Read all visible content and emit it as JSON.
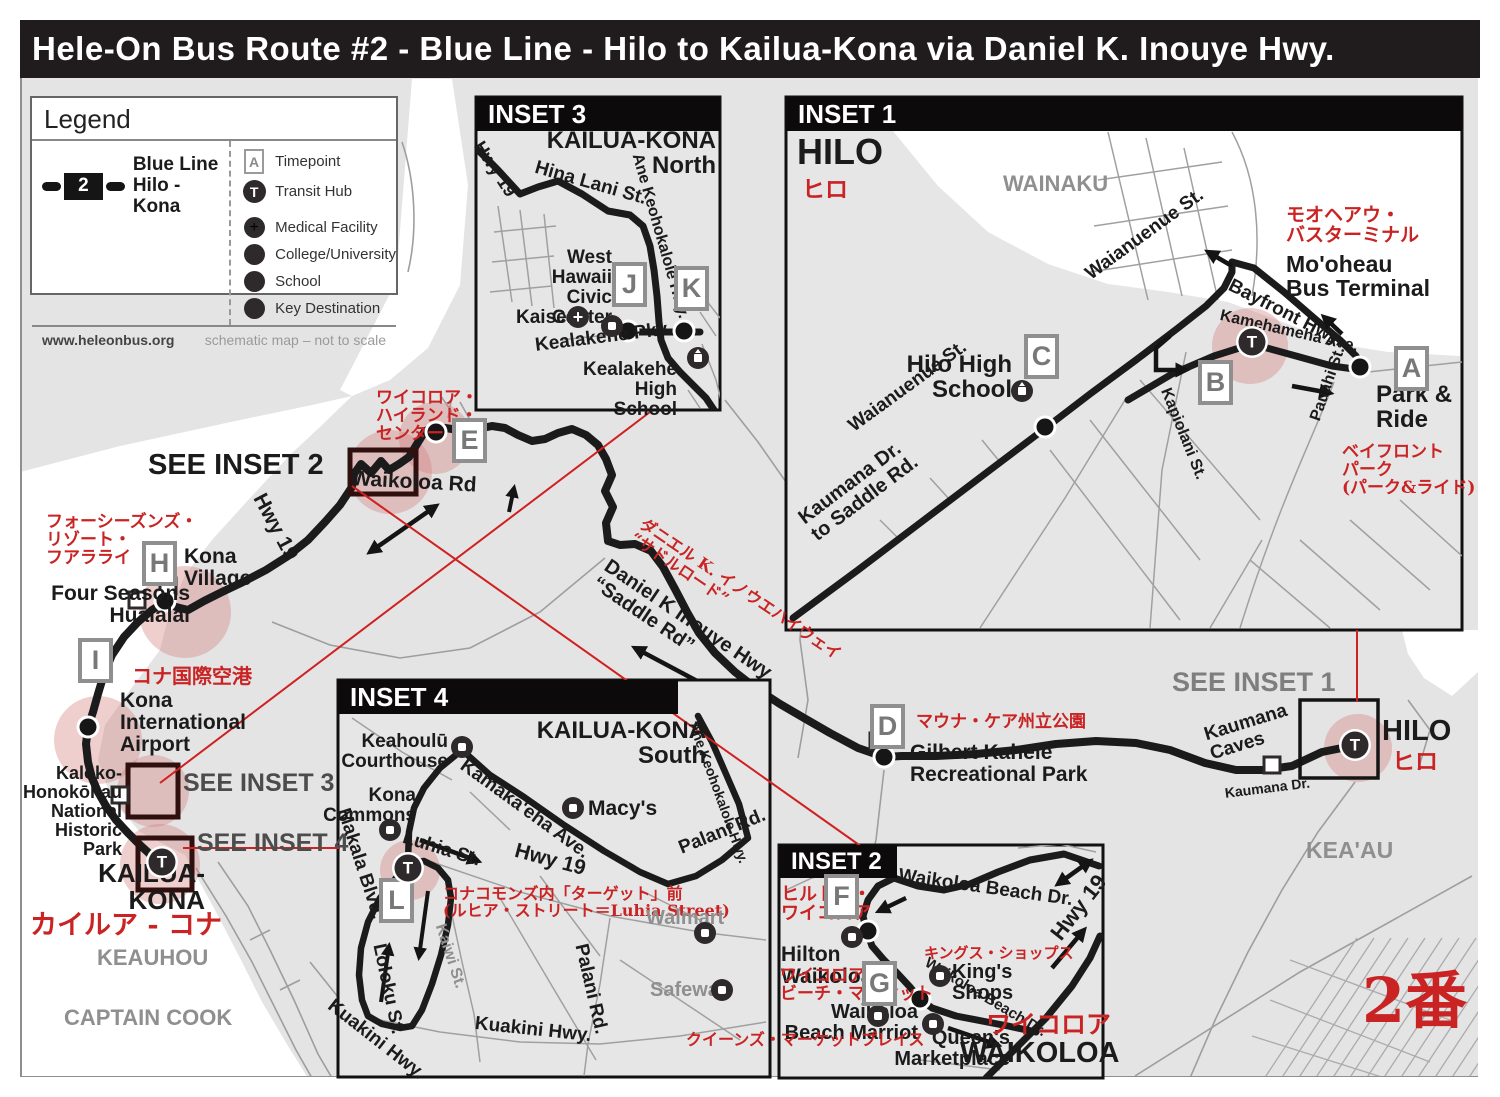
{
  "title": "Hele-On Bus Route #2 - Blue Line - Hilo to Kailua-Kona via Daniel K. Inouye Hwy.",
  "legend": {
    "heading": "Legend",
    "route_badge": "2",
    "route_name": "Blue Line\nHilo - Kona",
    "items": [
      {
        "icon": "timepoint-icon",
        "label": "Timepoint"
      },
      {
        "icon": "transit-hub-icon",
        "label": "Transit Hub"
      },
      {
        "icon": "medical-icon",
        "label": "Medical Facility"
      },
      {
        "icon": "college-icon",
        "label": "College/University"
      },
      {
        "icon": "school-icon",
        "label": "School"
      },
      {
        "icon": "key-destination-icon",
        "label": "Key Destination"
      }
    ],
    "website": "www.heleonbus.org",
    "note": "schematic map – not to scale"
  },
  "transit_hub_letter": "T",
  "insets": {
    "inset1": {
      "header": "INSET 1"
    },
    "inset2": {
      "header": "INSET 2"
    },
    "inset3": {
      "header": "INSET 3"
    },
    "inset4": {
      "header": "INSET 4"
    }
  },
  "map": {
    "labels": [
      {
        "n": "see-inset-2-label",
        "t": "SEE INSET 2",
        "x": 148,
        "y": 450,
        "s": 29,
        "c": "black"
      },
      {
        "n": "waikoloa-rd-label",
        "t": "Waikoloa Rd",
        "x": 352,
        "y": 468,
        "s": 21,
        "c": "black",
        "r": 3
      },
      {
        "n": "hwy-19-label-main",
        "t": "Hwy 19",
        "x": 268,
        "y": 490,
        "s": 21,
        "c": "black",
        "r": 62
      },
      {
        "n": "waikoloa-highlands-jp",
        "t": "ワイコロア・\nハイランド・\nセンター",
        "x": 376,
        "y": 390,
        "s": 17,
        "c": "red"
      },
      {
        "n": "four-seasons-jp",
        "t": "フォーシーズンズ・\nリゾート・\nフアラライ",
        "x": 46,
        "y": 514,
        "s": 17,
        "c": "red"
      },
      {
        "n": "kona-village-label",
        "t": "Kona\nVillage",
        "x": 184,
        "y": 546,
        "s": 21,
        "c": "black"
      },
      {
        "n": "four-seasons-label",
        "t": "Four Seasons\nHualalai",
        "x": 190,
        "y": 583,
        "s": 21,
        "c": "black",
        "a": "r"
      },
      {
        "n": "kona-airport-jp",
        "t": "コナ国際空港",
        "x": 132,
        "y": 666,
        "s": 20,
        "c": "red"
      },
      {
        "n": "kona-airport-label",
        "t": "Kona\nInternational\nAirport",
        "x": 120,
        "y": 690,
        "s": 21,
        "c": "black"
      },
      {
        "n": "kaloko-label",
        "t": "Kaloko-\nHonokōhau\nNational\nHistoric\nPark",
        "x": 122,
        "y": 764,
        "s": 18,
        "c": "black",
        "a": "r"
      },
      {
        "n": "see-inset-3-label",
        "t": "SEE INSET 3",
        "x": 183,
        "y": 770,
        "s": 25,
        "c": "dgray"
      },
      {
        "n": "see-inset-4-label",
        "t": "SEE INSET 4",
        "x": 197,
        "y": 830,
        "s": 25,
        "c": "dgray"
      },
      {
        "n": "kailua-kona-label",
        "t": "KAILUA-\nKONA",
        "x": 205,
        "y": 860,
        "s": 26,
        "c": "black",
        "a": "r"
      },
      {
        "n": "kailua-kona-jp",
        "t": "カイルア - コナ",
        "x": 30,
        "y": 912,
        "s": 27,
        "c": "red"
      },
      {
        "n": "keauhou-label",
        "t": "KEAUHOU",
        "x": 97,
        "y": 946,
        "s": 22,
        "c": "gray"
      },
      {
        "n": "captain-cook-label",
        "t": "CAPTAIN COOK",
        "x": 64,
        "y": 1006,
        "s": 22,
        "c": "gray"
      },
      {
        "n": "daniel-hwy-jp",
        "t": "ダニエル K. イノウエハイウェイ\n“サドルロード”",
        "x": 646,
        "y": 516,
        "s": 16,
        "c": "red",
        "r": 34
      },
      {
        "n": "daniel-hwy-label",
        "t": "Daniel K Inouye Hwy\n“Saddle Rd”",
        "x": 612,
        "y": 556,
        "s": 20,
        "c": "black",
        "r": 34
      },
      {
        "n": "mauna-kea-jp",
        "t": "マウナ・ケア州立公園",
        "x": 916,
        "y": 714,
        "s": 17,
        "c": "red"
      },
      {
        "n": "gilbert-kahele-label",
        "t": "Gilbert Kahele\nRecreational Park",
        "x": 910,
        "y": 742,
        "s": 21,
        "c": "black"
      },
      {
        "n": "see-inset-1-label",
        "t": "SEE INSET 1",
        "x": 1172,
        "y": 668,
        "s": 27,
        "c": "sgray"
      },
      {
        "n": "hilo-label-main",
        "t": "HILO",
        "x": 1382,
        "y": 716,
        "s": 29,
        "c": "black"
      },
      {
        "n": "hilo-jp-main",
        "t": "ヒロ",
        "x": 1392,
        "y": 750,
        "s": 23,
        "c": "red"
      },
      {
        "n": "kaumana-caves-label",
        "t": "Kaumana\nCaves",
        "x": 1202,
        "y": 726,
        "s": 19,
        "c": "black",
        "r": -17
      },
      {
        "n": "kaumana-dr-label",
        "t": "Kaumana Dr.",
        "x": 1224,
        "y": 786,
        "s": 14,
        "c": "black",
        "r": -7
      },
      {
        "n": "keaau-label",
        "t": "KEA'AU",
        "x": 1306,
        "y": 838,
        "s": 23,
        "c": "gray"
      },
      {
        "n": "route-number-jp",
        "t": "2番",
        "x": 1362,
        "y": 968,
        "s": 62,
        "c": "red"
      },
      {
        "n": "inset1-hilo-label",
        "t": "HILO",
        "x": 797,
        "y": 133,
        "s": 36,
        "c": "black"
      },
      {
        "n": "inset1-hilo-jp",
        "t": "ヒロ",
        "x": 802,
        "y": 178,
        "s": 23,
        "c": "red"
      },
      {
        "n": "wainaku-label",
        "t": "WAINAKU",
        "x": 1003,
        "y": 172,
        "s": 22,
        "c": "gray"
      },
      {
        "n": "waianuenue-upper-label",
        "t": "Waianuenue St.",
        "x": 1082,
        "y": 268,
        "s": 19,
        "c": "black",
        "r": -36
      },
      {
        "n": "moheau-jp",
        "t": "モオヘアウ・\nバスターミナル",
        "x": 1286,
        "y": 206,
        "s": 19,
        "c": "red"
      },
      {
        "n": "moheau-label",
        "t": "Mo'oheau\nBus Terminal",
        "x": 1286,
        "y": 252,
        "s": 23,
        "c": "black"
      },
      {
        "n": "bayfront-label",
        "t": "Bayfront Hwy.",
        "x": 1234,
        "y": 276,
        "s": 19,
        "c": "black",
        "r": 27
      },
      {
        "n": "kamehameha-label",
        "t": "Kamehameha Ave.",
        "x": 1222,
        "y": 308,
        "s": 16,
        "c": "black",
        "r": 13
      },
      {
        "n": "hilo-high-label",
        "t": "Hilo High\nSchool",
        "x": 1012,
        "y": 352,
        "s": 24,
        "c": "black",
        "a": "r"
      },
      {
        "n": "waianuenue-lower-label",
        "t": "Waianuenue St.",
        "x": 845,
        "y": 420,
        "s": 19,
        "c": "black",
        "r": -36
      },
      {
        "n": "kaumana-saddle-label",
        "t": "Kaumana Dr.\nto Saddle Rd.",
        "x": 795,
        "y": 512,
        "s": 20,
        "c": "black",
        "r": -37
      },
      {
        "n": "kapiolani-label",
        "t": "Kapiolani St.",
        "x": 1172,
        "y": 386,
        "s": 16,
        "c": "black",
        "r": 68
      },
      {
        "n": "pauahi-label",
        "t": "Pauahi St.",
        "x": 1308,
        "y": 418,
        "s": 16,
        "c": "black",
        "r": -71
      },
      {
        "n": "park-ride-label",
        "t": "Park &\nRide",
        "x": 1376,
        "y": 382,
        "s": 24,
        "c": "black"
      },
      {
        "n": "bayfront-park-jp",
        "t": "ベイフロント\nパーク\n(パーク&ライド)",
        "x": 1342,
        "y": 444,
        "s": 17,
        "c": "red"
      },
      {
        "n": "inset3-kailua-label",
        "t": "KAILUA-KONA\nNorth",
        "x": 716,
        "y": 128,
        "s": 24,
        "c": "black",
        "a": "r"
      },
      {
        "n": "inset3-hwy19-label",
        "t": "Hwy 19",
        "x": 486,
        "y": 138,
        "s": 18,
        "c": "black",
        "r": 57
      },
      {
        "n": "hina-lani-label",
        "t": "Hina Lani St.",
        "x": 538,
        "y": 158,
        "s": 19,
        "c": "black",
        "r": 16
      },
      {
        "n": "ane-keohokalole-i3-label",
        "t": "Ane Keohokalole Hwy.",
        "x": 644,
        "y": 152,
        "s": 16,
        "c": "black",
        "r": 74
      },
      {
        "n": "west-hawaii-label",
        "t": "West\nHawaii\nCivic\nCenter",
        "x": 612,
        "y": 248,
        "s": 19,
        "c": "black",
        "a": "r"
      },
      {
        "n": "kaiser-label",
        "t": "Kaiser",
        "x": 516,
        "y": 308,
        "s": 19,
        "c": "black"
      },
      {
        "n": "kealakehe-pky-label",
        "t": "Kealakehe Pky.",
        "x": 534,
        "y": 336,
        "s": 19,
        "c": "black",
        "r": -7
      },
      {
        "n": "kealakehe-high-label",
        "t": "Kealakehe\nHigh\nSchool",
        "x": 677,
        "y": 360,
        "s": 19,
        "c": "black",
        "a": "r"
      },
      {
        "n": "inset4-kailua-label",
        "t": "KAILUA-KONA\nSouth",
        "x": 706,
        "y": 718,
        "s": 24,
        "c": "black",
        "a": "r"
      },
      {
        "n": "keahoulu-label",
        "t": "Keahoulū\nCourthouse",
        "x": 448,
        "y": 732,
        "s": 19,
        "c": "black",
        "a": "r"
      },
      {
        "n": "kona-commons-label",
        "t": "Kona\nCommons",
        "x": 416,
        "y": 786,
        "s": 19,
        "c": "black",
        "a": "r"
      },
      {
        "n": "macys-label",
        "t": "Macy's",
        "x": 588,
        "y": 798,
        "s": 21,
        "c": "black"
      },
      {
        "n": "kamakaeha-label",
        "t": "Kamaka'eha Ave.",
        "x": 468,
        "y": 756,
        "s": 19,
        "c": "black",
        "r": 36
      },
      {
        "n": "ane-keohokalole-i4-label",
        "t": "Ane Keohokalole Hwy.",
        "x": 700,
        "y": 720,
        "s": 14,
        "c": "black",
        "r": 70
      },
      {
        "n": "palani-upper-label",
        "t": "Palani Rd.",
        "x": 676,
        "y": 840,
        "s": 19,
        "c": "black",
        "r": -22
      },
      {
        "n": "inset4-hwy19-label",
        "t": "Hwy 19",
        "x": 518,
        "y": 840,
        "s": 21,
        "c": "black",
        "r": 15
      },
      {
        "n": "luhia-label",
        "t": "Luhia St.",
        "x": 406,
        "y": 828,
        "s": 19,
        "c": "black",
        "r": 17
      },
      {
        "n": "kona-commons-target-jp",
        "t": "コナコモンズ内「ターゲット」前\n(ルヒア・ストリート＝Luhia Street)",
        "x": 443,
        "y": 886,
        "s": 16,
        "c": "red"
      },
      {
        "n": "makala-label",
        "t": "Makala Blvd.",
        "x": 352,
        "y": 806,
        "s": 19,
        "c": "black",
        "r": 72
      },
      {
        "n": "loloku-label",
        "t": "Loloku St.",
        "x": 388,
        "y": 942,
        "s": 19,
        "c": "black",
        "r": 78
      },
      {
        "n": "kuakini-left-label",
        "t": "Kuakini Hwy.",
        "x": 336,
        "y": 996,
        "s": 19,
        "c": "black",
        "r": 38
      },
      {
        "n": "kuakini-mid-label",
        "t": "Kuakini Hwy.",
        "x": 476,
        "y": 1014,
        "s": 19,
        "c": "black",
        "r": 6
      },
      {
        "n": "palani-lower-label",
        "t": "Palani Rd.",
        "x": 590,
        "y": 942,
        "s": 19,
        "c": "black",
        "r": 77
      },
      {
        "n": "kaiwi-label",
        "t": "Kaiwi St.",
        "x": 447,
        "y": 922,
        "s": 16,
        "c": "gray",
        "r": 72
      },
      {
        "n": "walmart-label",
        "t": "Walmart",
        "x": 646,
        "y": 908,
        "s": 20,
        "c": "gray"
      },
      {
        "n": "safeway-label",
        "t": "Safeway",
        "x": 650,
        "y": 980,
        "s": 20,
        "c": "gray"
      },
      {
        "n": "hilton-jp",
        "t": "ヒルトン・\nワイコロア",
        "x": 781,
        "y": 886,
        "s": 18,
        "c": "red"
      },
      {
        "n": "hilton-label",
        "t": "Hilton\nWaikoloa",
        "x": 781,
        "y": 944,
        "s": 21,
        "c": "black"
      },
      {
        "n": "waikoloa-beach-dr-upper-label",
        "t": "Waikoloa Beach Dr.",
        "x": 900,
        "y": 866,
        "s": 19,
        "c": "black",
        "r": 8
      },
      {
        "n": "kings-shops-jp",
        "t": "キングス・ショップス",
        "x": 924,
        "y": 946,
        "s": 15,
        "c": "red"
      },
      {
        "n": "kings-shops-label",
        "t": "King's\nShops",
        "x": 952,
        "y": 962,
        "s": 20,
        "c": "black"
      },
      {
        "n": "inset2-hwy19-label",
        "t": "Hwy 19",
        "x": 1046,
        "y": 930,
        "s": 22,
        "c": "black",
        "r": -52
      },
      {
        "n": "marriott-jp",
        "t": "ワイコロア・\nビーチ・マリオット",
        "x": 780,
        "y": 968,
        "s": 17,
        "c": "red"
      },
      {
        "n": "waikoloa-beach-dr-lower-label",
        "t": "Waikoloa Beach Dr.",
        "x": 930,
        "y": 955,
        "s": 15,
        "c": "black",
        "r": 31
      },
      {
        "n": "marriott-label",
        "t": "Waikoloa\nBeach Marriot",
        "x": 918,
        "y": 1002,
        "s": 20,
        "c": "black",
        "a": "r"
      },
      {
        "n": "queens-jp",
        "t": "クイーンズ・マーケットプレイス",
        "x": 686,
        "y": 1032,
        "s": 16,
        "c": "red"
      },
      {
        "n": "queens-label",
        "t": "Queen's\nMarketplace",
        "x": 1010,
        "y": 1028,
        "s": 20,
        "c": "black",
        "a": "r"
      },
      {
        "n": "waikoloa-jp",
        "t": "ワイコロア",
        "x": 986,
        "y": 1012,
        "s": 25,
        "c": "red"
      },
      {
        "n": "waikoloa-label",
        "t": "WAIKOLOA",
        "x": 960,
        "y": 1038,
        "s": 29,
        "c": "black"
      }
    ],
    "timepoints": [
      {
        "letter": "A",
        "x": 1394,
        "y": 346
      },
      {
        "letter": "B",
        "x": 1198,
        "y": 360
      },
      {
        "letter": "C",
        "x": 1024,
        "y": 334
      },
      {
        "letter": "D",
        "x": 870,
        "y": 704
      },
      {
        "letter": "E",
        "x": 452,
        "y": 418
      },
      {
        "letter": "F",
        "x": 824,
        "y": 874
      },
      {
        "letter": "G",
        "x": 862,
        "y": 961
      },
      {
        "letter": "H",
        "x": 142,
        "y": 541
      },
      {
        "letter": "I",
        "x": 78,
        "y": 638
      },
      {
        "letter": "J",
        "x": 612,
        "y": 262
      },
      {
        "letter": "K",
        "x": 674,
        "y": 266
      },
      {
        "letter": "L",
        "x": 379,
        "y": 878
      }
    ],
    "transit_hubs": [
      {
        "x": 162,
        "y": 862
      },
      {
        "x": 1355,
        "y": 745
      },
      {
        "x": 1252,
        "y": 342
      },
      {
        "x": 408,
        "y": 868
      }
    ],
    "icons": [
      {
        "k": "keydest",
        "n": "key-destination-icon",
        "x": 612,
        "y": 326
      },
      {
        "k": "keydest",
        "n": "key-destination-icon",
        "x": 462,
        "y": 747
      },
      {
        "k": "keydest",
        "n": "key-destination-icon",
        "x": 390,
        "y": 830
      },
      {
        "k": "keydest",
        "n": "key-destination-icon",
        "x": 573,
        "y": 808
      },
      {
        "k": "keydest",
        "n": "key-destination-icon",
        "x": 705,
        "y": 933
      },
      {
        "k": "keydest",
        "n": "key-destination-icon",
        "x": 722,
        "y": 990
      },
      {
        "k": "keydest",
        "n": "key-destination-icon",
        "x": 852,
        "y": 937
      },
      {
        "k": "keydest",
        "n": "key-destination-icon",
        "x": 940,
        "y": 976
      },
      {
        "k": "keydest",
        "n": "key-destination-icon",
        "x": 878,
        "y": 1016
      },
      {
        "k": "keydest",
        "n": "key-destination-icon",
        "x": 933,
        "y": 1024
      },
      {
        "k": "medical",
        "n": "medical-facility-icon",
        "x": 578,
        "y": 317
      },
      {
        "k": "school",
        "n": "school-icon",
        "x": 698,
        "y": 358
      },
      {
        "k": "school",
        "n": "school-icon",
        "x": 1022,
        "y": 391
      }
    ],
    "squares": [
      {
        "x": 168,
        "y": 586
      },
      {
        "x": 137,
        "y": 600
      },
      {
        "x": 120,
        "y": 795
      },
      {
        "x": 1272,
        "y": 765
      },
      {
        "x": 878,
        "y": 741
      }
    ],
    "dots": [
      {
        "x": 436,
        "y": 432
      },
      {
        "x": 165,
        "y": 601
      },
      {
        "x": 88,
        "y": 727
      },
      {
        "x": 884,
        "y": 757
      },
      {
        "x": 1045,
        "y": 427
      },
      {
        "x": 1360,
        "y": 367
      },
      {
        "x": 628,
        "y": 331
      },
      {
        "x": 684,
        "y": 331
      },
      {
        "x": 868,
        "y": 931
      },
      {
        "x": 920,
        "y": 999
      }
    ]
  },
  "colors": {
    "route": "#1b1b1b",
    "accent_red": "#c92323",
    "land": "#e4e4e4",
    "ocean": "#ffffff",
    "highlight_pink": "rgba(214,126,126,0.38)"
  }
}
